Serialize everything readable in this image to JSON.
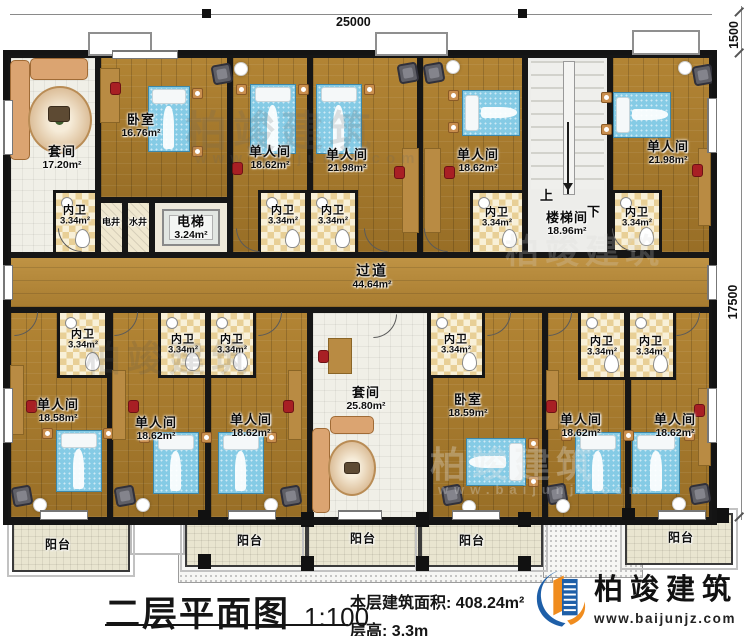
{
  "title_block": {
    "title": "二层平面图",
    "scale": "1:100",
    "area_label": "本层建筑面积:",
    "area_value": "408.24m²",
    "floor_height_label": "层高:",
    "floor_height_value": "3.3m"
  },
  "brand": {
    "name": "柏竣建筑",
    "url": "www.baijunjz.com",
    "blue": "#1e5fa8",
    "orange": "#f08c1e"
  },
  "dims": {
    "top": "25000",
    "right_top": "1500",
    "right_side": "17500"
  },
  "stairs": {
    "up": "上",
    "down": "下"
  },
  "rooms": [
    {
      "id": "suite-top",
      "label": "套间",
      "area": "17.20m²",
      "floor": "tile",
      "x": 8,
      "y": 55,
      "w": 90,
      "h": 200,
      "lx": 62,
      "ly": 158
    },
    {
      "id": "bedroom-top",
      "label": "卧室",
      "area": "16.76m²",
      "floor": "wood",
      "x": 98,
      "y": 55,
      "w": 132,
      "h": 145,
      "lx": 141,
      "ly": 126
    },
    {
      "id": "single-a",
      "label": "单人间",
      "area": "18.62m²",
      "floor": "wood",
      "x": 230,
      "y": 55,
      "w": 80,
      "h": 200,
      "lx": 270,
      "ly": 158
    },
    {
      "id": "single-b",
      "label": "单人间",
      "area": "21.98m²",
      "floor": "wood",
      "x": 310,
      "y": 55,
      "w": 110,
      "h": 200,
      "lx": 347,
      "ly": 161
    },
    {
      "id": "single-c",
      "label": "单人间",
      "area": "18.62m²",
      "floor": "wood",
      "x": 420,
      "y": 55,
      "w": 105,
      "h": 200,
      "lx": 478,
      "ly": 161
    },
    {
      "id": "stairwell",
      "label": "楼梯间",
      "area": "18.96m²",
      "floor": "stair",
      "x": 525,
      "y": 55,
      "w": 85,
      "h": 200,
      "lx": 567,
      "ly": 224
    },
    {
      "id": "single-d",
      "label": "单人间",
      "area": "21.98m²",
      "floor": "wood",
      "x": 610,
      "y": 55,
      "w": 102,
      "h": 200,
      "lx": 668,
      "ly": 153
    },
    {
      "id": "corridor",
      "label": "过道",
      "area": "44.64m²",
      "floor": "corridor",
      "x": 8,
      "y": 255,
      "w": 704,
      "h": 55,
      "lx": 372,
      "ly": 277,
      "cls": "lbl-corridor"
    },
    {
      "id": "single-e",
      "label": "单人间",
      "area": "18.58m²",
      "floor": "wood",
      "x": 8,
      "y": 310,
      "w": 102,
      "h": 210,
      "lx": 58,
      "ly": 411
    },
    {
      "id": "single-f",
      "label": "单人间",
      "area": "18.62m²",
      "floor": "wood",
      "x": 110,
      "y": 310,
      "w": 98,
      "h": 210,
      "lx": 156,
      "ly": 429
    },
    {
      "id": "single-g",
      "label": "单人间",
      "area": "18.62m²",
      "floor": "wood",
      "x": 208,
      "y": 310,
      "w": 102,
      "h": 210,
      "lx": 251,
      "ly": 426
    },
    {
      "id": "suite-bottom",
      "label": "套间",
      "area": "25.80m²",
      "floor": "tile",
      "x": 310,
      "y": 310,
      "w": 120,
      "h": 210,
      "lx": 366,
      "ly": 399
    },
    {
      "id": "bedroom-bottom",
      "label": "卧室",
      "area": "18.59m²",
      "floor": "wood",
      "x": 430,
      "y": 310,
      "w": 115,
      "h": 210,
      "lx": 468,
      "ly": 406
    },
    {
      "id": "single-h",
      "label": "单人间",
      "area": "18.62m²",
      "floor": "wood",
      "x": 545,
      "y": 310,
      "w": 83,
      "h": 210,
      "lx": 581,
      "ly": 426
    },
    {
      "id": "single-i",
      "label": "单人间",
      "area": "18.62m²",
      "floor": "wood",
      "x": 628,
      "y": 310,
      "w": 84,
      "h": 210,
      "lx": 675,
      "ly": 426
    },
    {
      "id": "elevator",
      "label": "电梯",
      "area": "3.24m²",
      "floor": "elevator",
      "x": 152,
      "y": 200,
      "w": 78,
      "h": 55,
      "lx": 191,
      "ly": 228
    },
    {
      "id": "shaft-elec",
      "label": "电井",
      "floor": "shaft",
      "x": 98,
      "y": 200,
      "w": 27,
      "h": 55,
      "lx": 111,
      "ly": 222,
      "cls": "lbl-small"
    },
    {
      "id": "shaft-water",
      "label": "水井",
      "floor": "shaft",
      "x": 125,
      "y": 200,
      "w": 27,
      "h": 55,
      "lx": 138,
      "ly": 222,
      "cls": "lbl-small"
    }
  ],
  "bath_label": {
    "label": "内卫",
    "area": "3.34m²"
  },
  "baths": [
    {
      "x": 53,
      "y": 190,
      "w": 45,
      "h": 65,
      "lx": 75,
      "ly": 216
    },
    {
      "x": 258,
      "y": 190,
      "w": 50,
      "h": 65,
      "lx": 283,
      "ly": 216
    },
    {
      "x": 308,
      "y": 190,
      "w": 50,
      "h": 65,
      "lx": 333,
      "ly": 216
    },
    {
      "x": 470,
      "y": 190,
      "w": 55,
      "h": 65,
      "lx": 497,
      "ly": 218
    },
    {
      "x": 612,
      "y": 190,
      "w": 50,
      "h": 63,
      "lx": 637,
      "ly": 218
    },
    {
      "x": 57,
      "y": 310,
      "w": 51,
      "h": 68,
      "lx": 83,
      "ly": 340
    },
    {
      "x": 158,
      "y": 310,
      "w": 50,
      "h": 68,
      "lx": 183,
      "ly": 345
    },
    {
      "x": 208,
      "y": 310,
      "w": 48,
      "h": 68,
      "lx": 232,
      "ly": 345
    },
    {
      "x": 428,
      "y": 310,
      "w": 57,
      "h": 68,
      "lx": 456,
      "ly": 345
    },
    {
      "x": 578,
      "y": 310,
      "w": 49,
      "h": 70,
      "lx": 602,
      "ly": 347
    },
    {
      "x": 627,
      "y": 310,
      "w": 49,
      "h": 70,
      "lx": 651,
      "ly": 347
    }
  ],
  "balcony_label": {
    "label": "阳台"
  },
  "balconies": [
    {
      "x": 12,
      "y": 520,
      "w": 118,
      "h": 52,
      "lx": 58,
      "ly": 545
    },
    {
      "x": 185,
      "y": 517,
      "w": 122,
      "h": 50,
      "lx": 250,
      "ly": 541
    },
    {
      "x": 307,
      "y": 517,
      "w": 113,
      "h": 50,
      "lx": 363,
      "ly": 539
    },
    {
      "x": 420,
      "y": 517,
      "w": 123,
      "h": 50,
      "lx": 472,
      "ly": 541
    },
    {
      "x": 625,
      "y": 513,
      "w": 108,
      "h": 52,
      "lx": 681,
      "ly": 538
    }
  ],
  "furniture": [
    {
      "t": "bed-v",
      "x": 148,
      "y": 86,
      "w": 42,
      "h": 66
    },
    {
      "t": "bed-v",
      "x": 250,
      "y": 84,
      "w": 46,
      "h": 70
    },
    {
      "t": "bed-v",
      "x": 316,
      "y": 84,
      "w": 46,
      "h": 70
    },
    {
      "t": "bed-h",
      "x": 462,
      "y": 90,
      "w": 58,
      "h": 46
    },
    {
      "t": "bed-h",
      "x": 613,
      "y": 92,
      "w": 58,
      "h": 46
    },
    {
      "t": "bed-v",
      "x": 56,
      "y": 430,
      "w": 46,
      "h": 62
    },
    {
      "t": "bed-v",
      "x": 153,
      "y": 432,
      "w": 46,
      "h": 62
    },
    {
      "t": "bed-v",
      "x": 218,
      "y": 432,
      "w": 46,
      "h": 62
    },
    {
      "t": "bed-v",
      "x": 575,
      "y": 432,
      "w": 46,
      "h": 62
    },
    {
      "t": "bed-v",
      "x": 632,
      "y": 432,
      "w": 48,
      "h": 62
    },
    {
      "t": "bed-hr",
      "x": 466,
      "y": 438,
      "w": 60,
      "h": 48
    },
    {
      "t": "stand",
      "x": 192,
      "y": 88,
      "w": 11,
      "h": 11
    },
    {
      "t": "stand",
      "x": 192,
      "y": 146,
      "w": 11,
      "h": 11
    },
    {
      "t": "stand",
      "x": 236,
      "y": 84,
      "w": 11,
      "h": 11
    },
    {
      "t": "stand",
      "x": 298,
      "y": 84,
      "w": 11,
      "h": 11
    },
    {
      "t": "stand",
      "x": 364,
      "y": 84,
      "w": 11,
      "h": 11
    },
    {
      "t": "stand",
      "x": 448,
      "y": 90,
      "w": 11,
      "h": 11
    },
    {
      "t": "stand",
      "x": 448,
      "y": 122,
      "w": 11,
      "h": 11
    },
    {
      "t": "stand",
      "x": 601,
      "y": 92,
      "w": 11,
      "h": 11
    },
    {
      "t": "stand",
      "x": 601,
      "y": 124,
      "w": 11,
      "h": 11
    },
    {
      "t": "stand",
      "x": 42,
      "y": 428,
      "w": 11,
      "h": 11
    },
    {
      "t": "stand",
      "x": 103,
      "y": 428,
      "w": 11,
      "h": 11
    },
    {
      "t": "stand",
      "x": 139,
      "y": 432,
      "w": 11,
      "h": 11
    },
    {
      "t": "stand",
      "x": 201,
      "y": 432,
      "w": 11,
      "h": 11
    },
    {
      "t": "stand",
      "x": 266,
      "y": 432,
      "w": 11,
      "h": 11
    },
    {
      "t": "stand",
      "x": 561,
      "y": 430,
      "w": 11,
      "h": 11
    },
    {
      "t": "stand",
      "x": 623,
      "y": 430,
      "w": 11,
      "h": 11
    },
    {
      "t": "stand",
      "x": 684,
      "y": 430,
      "w": 11,
      "h": 11
    },
    {
      "t": "stand",
      "x": 528,
      "y": 438,
      "w": 11,
      "h": 11
    },
    {
      "t": "stand",
      "x": 528,
      "y": 476,
      "w": 11,
      "h": 11
    },
    {
      "t": "desk",
      "x": 100,
      "y": 68,
      "w": 20,
      "h": 55
    },
    {
      "t": "desk",
      "x": 402,
      "y": 148,
      "w": 17,
      "h": 85
    },
    {
      "t": "desk",
      "x": 424,
      "y": 148,
      "w": 17,
      "h": 85
    },
    {
      "t": "desk",
      "x": 698,
      "y": 148,
      "w": 13,
      "h": 78
    },
    {
      "t": "desk",
      "x": 698,
      "y": 388,
      "w": 13,
      "h": 78
    },
    {
      "t": "desk",
      "x": 328,
      "y": 338,
      "w": 24,
      "h": 36
    },
    {
      "t": "desk",
      "x": 10,
      "y": 365,
      "w": 14,
      "h": 70
    },
    {
      "t": "desk",
      "x": 112,
      "y": 370,
      "w": 14,
      "h": 70
    },
    {
      "t": "desk",
      "x": 288,
      "y": 370,
      "w": 14,
      "h": 70
    },
    {
      "t": "desk",
      "x": 546,
      "y": 370,
      "w": 13,
      "h": 60
    },
    {
      "t": "rchair",
      "x": 110,
      "y": 82,
      "w": 11,
      "h": 13
    },
    {
      "t": "rchair",
      "x": 232,
      "y": 162,
      "w": 11,
      "h": 13
    },
    {
      "t": "rchair",
      "x": 394,
      "y": 166,
      "w": 11,
      "h": 13
    },
    {
      "t": "rchair",
      "x": 444,
      "y": 166,
      "w": 11,
      "h": 13
    },
    {
      "t": "rchair",
      "x": 692,
      "y": 164,
      "w": 11,
      "h": 13
    },
    {
      "t": "rchair",
      "x": 318,
      "y": 350,
      "w": 11,
      "h": 13
    },
    {
      "t": "rchair",
      "x": 26,
      "y": 400,
      "w": 11,
      "h": 13
    },
    {
      "t": "rchair",
      "x": 128,
      "y": 400,
      "w": 11,
      "h": 13
    },
    {
      "t": "rchair",
      "x": 283,
      "y": 400,
      "w": 11,
      "h": 13
    },
    {
      "t": "rchair",
      "x": 546,
      "y": 400,
      "w": 11,
      "h": 13
    },
    {
      "t": "rchair",
      "x": 694,
      "y": 404,
      "w": 11,
      "h": 13
    },
    {
      "t": "chair",
      "x": 212,
      "y": 64,
      "w": 20,
      "h": 20
    },
    {
      "t": "chair",
      "x": 398,
      "y": 63,
      "w": 20,
      "h": 20
    },
    {
      "t": "chair",
      "x": 424,
      "y": 63,
      "w": 20,
      "h": 20
    },
    {
      "t": "chair",
      "x": 693,
      "y": 65,
      "w": 20,
      "h": 20
    },
    {
      "t": "chair",
      "x": 12,
      "y": 486,
      "w": 20,
      "h": 20
    },
    {
      "t": "chair",
      "x": 115,
      "y": 486,
      "w": 20,
      "h": 20
    },
    {
      "t": "chair",
      "x": 281,
      "y": 486,
      "w": 20,
      "h": 20
    },
    {
      "t": "chair",
      "x": 442,
      "y": 485,
      "w": 20,
      "h": 20
    },
    {
      "t": "chair",
      "x": 547,
      "y": 484,
      "w": 20,
      "h": 20
    },
    {
      "t": "chair",
      "x": 690,
      "y": 484,
      "w": 20,
      "h": 20
    },
    {
      "t": "lamp",
      "x": 234,
      "y": 62,
      "w": 14,
      "h": 14
    },
    {
      "t": "lamp",
      "x": 446,
      "y": 60,
      "w": 14,
      "h": 14
    },
    {
      "t": "lamp",
      "x": 678,
      "y": 61,
      "w": 14,
      "h": 14
    },
    {
      "t": "lamp",
      "x": 33,
      "y": 498,
      "w": 14,
      "h": 14
    },
    {
      "t": "lamp",
      "x": 136,
      "y": 498,
      "w": 14,
      "h": 14
    },
    {
      "t": "lamp",
      "x": 264,
      "y": 498,
      "w": 14,
      "h": 14
    },
    {
      "t": "lamp",
      "x": 462,
      "y": 500,
      "w": 14,
      "h": 14
    },
    {
      "t": "lamp",
      "x": 556,
      "y": 499,
      "w": 14,
      "h": 14
    },
    {
      "t": "lamp",
      "x": 672,
      "y": 497,
      "w": 14,
      "h": 14
    },
    {
      "t": "sofa",
      "x": 10,
      "y": 60,
      "w": 20,
      "h": 100
    },
    {
      "t": "sofa",
      "x": 30,
      "y": 58,
      "w": 58,
      "h": 22
    },
    {
      "t": "rug",
      "x": 28,
      "y": 86,
      "w": 64,
      "h": 68
    },
    {
      "t": "ctable",
      "x": 48,
      "y": 106,
      "w": 22,
      "h": 16
    },
    {
      "t": "sofa",
      "x": 312,
      "y": 428,
      "w": 18,
      "h": 85
    },
    {
      "t": "sofa",
      "x": 330,
      "y": 416,
      "w": 44,
      "h": 18
    },
    {
      "t": "rug",
      "x": 328,
      "y": 440,
      "w": 48,
      "h": 56
    },
    {
      "t": "ctable",
      "x": 344,
      "y": 462,
      "w": 16,
      "h": 12
    }
  ],
  "bays": [
    {
      "x": 88,
      "y": 32,
      "w": 64,
      "h": 24
    },
    {
      "x": 375,
      "y": 32,
      "w": 73,
      "h": 24
    },
    {
      "x": 632,
      "y": 30,
      "w": 68,
      "h": 25
    }
  ],
  "windows": [
    {
      "x": 112,
      "y": 50,
      "w": 66,
      "h": 9
    },
    {
      "x": 3,
      "y": 100,
      "w": 10,
      "h": 55
    },
    {
      "x": 3,
      "y": 388,
      "w": 10,
      "h": 55
    },
    {
      "x": 707,
      "y": 98,
      "w": 10,
      "h": 55
    },
    {
      "x": 707,
      "y": 388,
      "w": 10,
      "h": 55
    },
    {
      "x": 3,
      "y": 265,
      "w": 10,
      "h": 35
    },
    {
      "x": 707,
      "y": 265,
      "w": 10,
      "h": 35
    },
    {
      "x": 40,
      "y": 510,
      "w": 48,
      "h": 10
    },
    {
      "x": 228,
      "y": 510,
      "w": 48,
      "h": 10
    },
    {
      "x": 338,
      "y": 510,
      "w": 44,
      "h": 10
    },
    {
      "x": 452,
      "y": 510,
      "w": 48,
      "h": 10
    },
    {
      "x": 658,
      "y": 510,
      "w": 48,
      "h": 10
    }
  ],
  "doors": [
    {
      "x": 58,
      "y": 228,
      "r": 90
    },
    {
      "x": 236,
      "y": 228,
      "r": 90
    },
    {
      "x": 364,
      "y": 228,
      "r": 90
    },
    {
      "x": 424,
      "y": 228,
      "r": 90
    },
    {
      "x": 612,
      "y": 228,
      "r": 90
    },
    {
      "x": 14,
      "y": 312,
      "r": 0
    },
    {
      "x": 114,
      "y": 312,
      "r": 0
    },
    {
      "x": 258,
      "y": 312,
      "r": 0
    },
    {
      "x": 373,
      "y": 314,
      "r": 0
    },
    {
      "x": 487,
      "y": 312,
      "r": 0
    },
    {
      "x": 548,
      "y": 312,
      "r": 0
    },
    {
      "x": 676,
      "y": 312,
      "r": 0
    }
  ],
  "pillars": [
    {
      "x": 198,
      "y": 510
    },
    {
      "x": 198,
      "y": 554
    },
    {
      "x": 301,
      "y": 512
    },
    {
      "x": 301,
      "y": 556
    },
    {
      "x": 416,
      "y": 512
    },
    {
      "x": 416,
      "y": 556
    },
    {
      "x": 518,
      "y": 512
    },
    {
      "x": 518,
      "y": 556
    },
    {
      "x": 622,
      "y": 508
    },
    {
      "x": 716,
      "y": 508
    }
  ],
  "stipples": [
    {
      "x": 178,
      "y": 503,
      "w": 375,
      "h": 80
    },
    {
      "x": 543,
      "y": 493,
      "w": 100,
      "h": 85
    }
  ],
  "watermarks": [
    {
      "text": "柏竣建筑",
      "x": 185,
      "y": 98,
      "size": 42,
      "opacity": 0.18,
      "color": "#666666"
    },
    {
      "text": "www.baijunjz.com",
      "x": 195,
      "y": 150,
      "size": 15,
      "opacity": 0.18,
      "color": "#666666"
    },
    {
      "text": "柏竣建筑",
      "x": 505,
      "y": 224,
      "size": 34,
      "opacity": 0.22,
      "color": "#d8d8d8"
    },
    {
      "text": "柏竣建筑",
      "x": 85,
      "y": 330,
      "size": 36,
      "opacity": 0.16,
      "color": "#555555"
    },
    {
      "text": "柏竣建筑",
      "x": 430,
      "y": 436,
      "size": 36,
      "opacity": 0.3,
      "color": "#e8e8e8"
    },
    {
      "text": "www.baijunjz.com",
      "x": 438,
      "y": 482,
      "size": 13,
      "opacity": 0.3,
      "color": "#e8e8e8"
    }
  ]
}
